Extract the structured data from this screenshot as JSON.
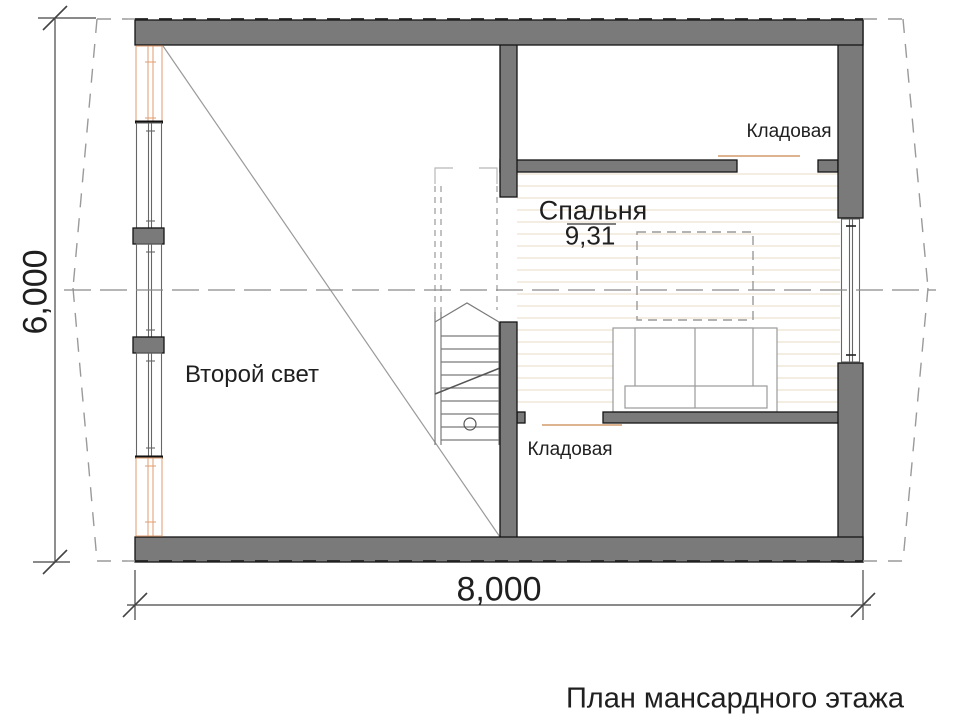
{
  "title": "План мансардного этажа",
  "rooms": {
    "storage_top": {
      "label": "Кладовая"
    },
    "storage_bottom": {
      "label": "Кладовая"
    },
    "bedroom": {
      "label": "Спальня",
      "area": "9,31"
    },
    "second_light": {
      "label": "Второй свет"
    }
  },
  "dimensions": {
    "width": "8,000",
    "height": "6,000"
  },
  "colors": {
    "wall_fill": "#7a7a7a",
    "leader_accent": "#d49a6a",
    "window_wood_accent": "#e2a47a",
    "floor_hatch": "#ece3d2",
    "roof_outline": "#9a9a9a"
  }
}
